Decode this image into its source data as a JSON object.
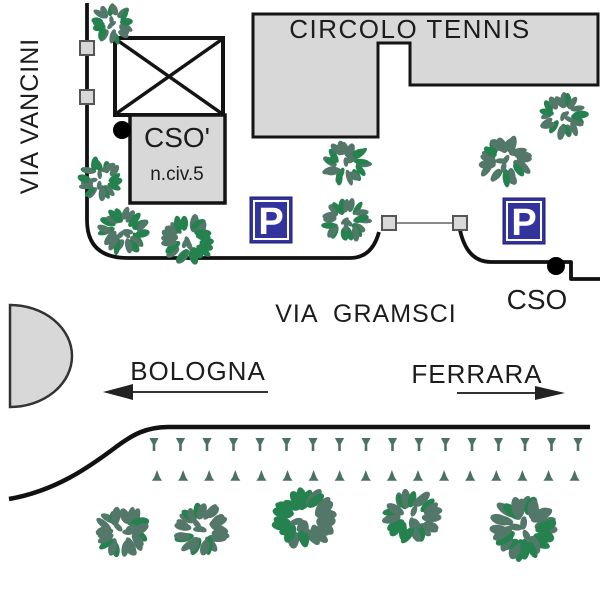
{
  "map": {
    "street_labels": {
      "vancini": "VIA VANCINI",
      "gramsci": "VIA  GRAMSCI"
    },
    "buildings": {
      "tennis": "CIRCOLO TENNIS",
      "cso_name": "CSO'",
      "cso_civic": "n.civ.5"
    },
    "destinations": {
      "west": "BOLOGNA",
      "east": "FERRARA"
    },
    "entrance_label": "CSO",
    "parking_sign": "P"
  },
  "colors": {
    "building_fill": "#d8d8d8",
    "outline": "#141414",
    "road": "#111111",
    "parking_bg": "#33339e",
    "parking_fg": "#ffffff",
    "leaf_dark": "#537769",
    "leaf_bright": "#25824f",
    "marker_green": "#4c7163",
    "text": "#1c1c1c"
  },
  "bushes": [
    {
      "x": 112,
      "y": 24,
      "r": 22
    },
    {
      "x": 100,
      "y": 179,
      "r": 23
    },
    {
      "x": 124,
      "y": 231,
      "r": 26
    },
    {
      "x": 187,
      "y": 240,
      "r": 27
    },
    {
      "x": 346,
      "y": 163,
      "r": 24
    },
    {
      "x": 346,
      "y": 220,
      "r": 24
    },
    {
      "x": 505,
      "y": 161,
      "r": 27
    },
    {
      "x": 563,
      "y": 116,
      "r": 24
    },
    {
      "x": 123,
      "y": 532,
      "r": 28
    },
    {
      "x": 201,
      "y": 529,
      "r": 29
    },
    {
      "x": 305,
      "y": 519,
      "r": 33
    },
    {
      "x": 412,
      "y": 516,
      "r": 29
    },
    {
      "x": 523,
      "y": 528,
      "r": 34
    }
  ],
  "hedges": {
    "top": {
      "x_start": 154,
      "y": 438,
      "count": 17,
      "spacing": 26.5
    },
    "bottom": {
      "x_start": 157,
      "y": 470,
      "count": 17,
      "spacing": 26.1
    }
  }
}
